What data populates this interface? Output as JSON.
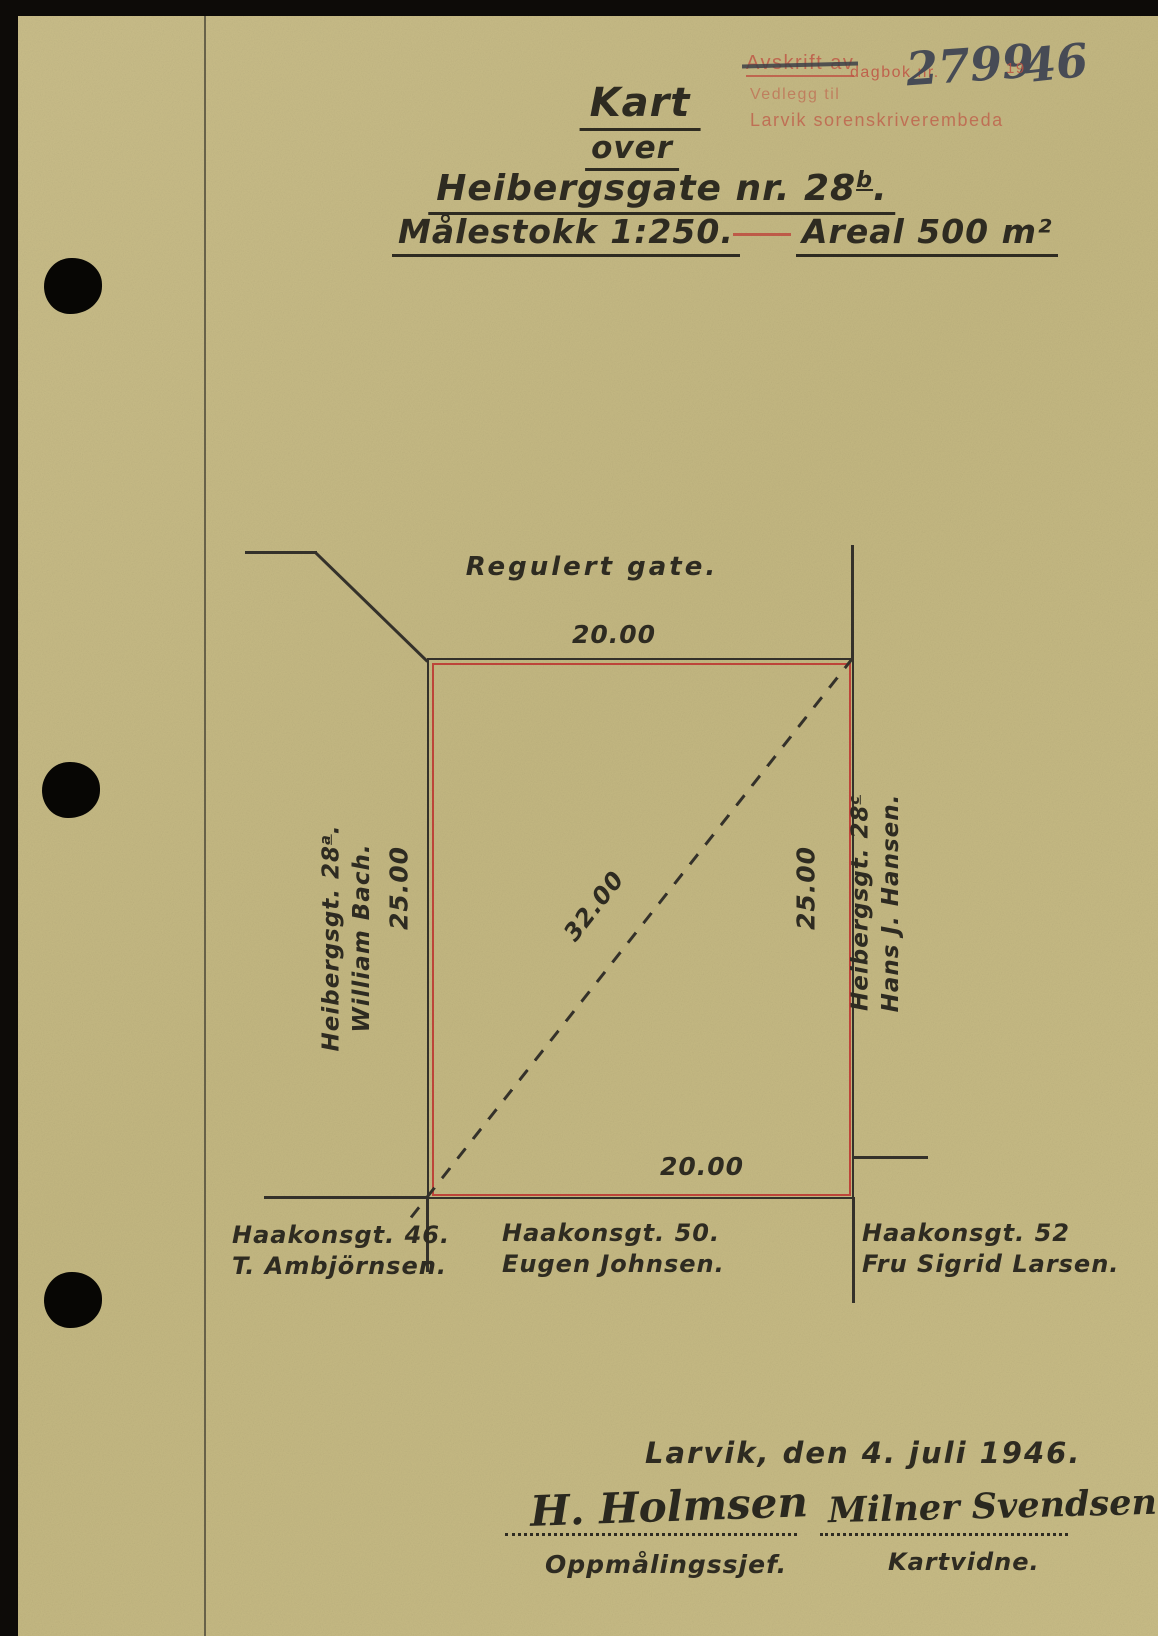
{
  "stamp": {
    "struck_label": "Avskrift av",
    "dagbok_label": "dagbok nr.",
    "dagbok_number": "2799",
    "year_prefix": "19",
    "year_suffix": "46",
    "attachment_line": "Vedlegg til",
    "office_line": "Larvik sorenskriverembeda"
  },
  "title": {
    "kart": "Kart",
    "over": "over",
    "street_main": "Heibergsgate nr. 28",
    "street_sup": "b",
    "street_end": ".",
    "scale": "Målestokk 1:250.",
    "area": "Areal 500 m²"
  },
  "map": {
    "street_label": "Regulert gate.",
    "dim_top": "20.00",
    "dim_bottom": "20.00",
    "dim_left": "25.00",
    "dim_right": "25.00",
    "dim_diagonal": "32.00",
    "west_neighbor": {
      "street": "Heibergsgt. 28",
      "sup": "a",
      "end": ".",
      "owner": "William Bach."
    },
    "east_neighbor": {
      "street": "Heibergsgt. 28",
      "sup": "c",
      "end": "",
      "owner": "Hans J. Hansen."
    },
    "south_neighbors": [
      {
        "street": "Haakonsgt. 46.",
        "owner": "T. Ambjörnsen."
      },
      {
        "street": "Haakonsgt. 50.",
        "owner": "Eugen Johnsen."
      },
      {
        "street": "Haakonsgt. 52",
        "owner": "Fru Sigrid Larsen."
      }
    ]
  },
  "footer": {
    "place_date": "Larvik, den 4. juli 1946.",
    "left_signature": {
      "name": "H. Holmsen",
      "title": "Oppmålingssjef."
    },
    "right_signature": {
      "name": "Milner Svendsen",
      "title": "Kartvidne."
    }
  },
  "colors": {
    "paper": "#c6ba85",
    "ink": "#2e2b21",
    "plot_red": "#bd4439",
    "stamp_red": "#bf5343",
    "pencil": "#474b55",
    "backdrop": "#0d0b08"
  }
}
